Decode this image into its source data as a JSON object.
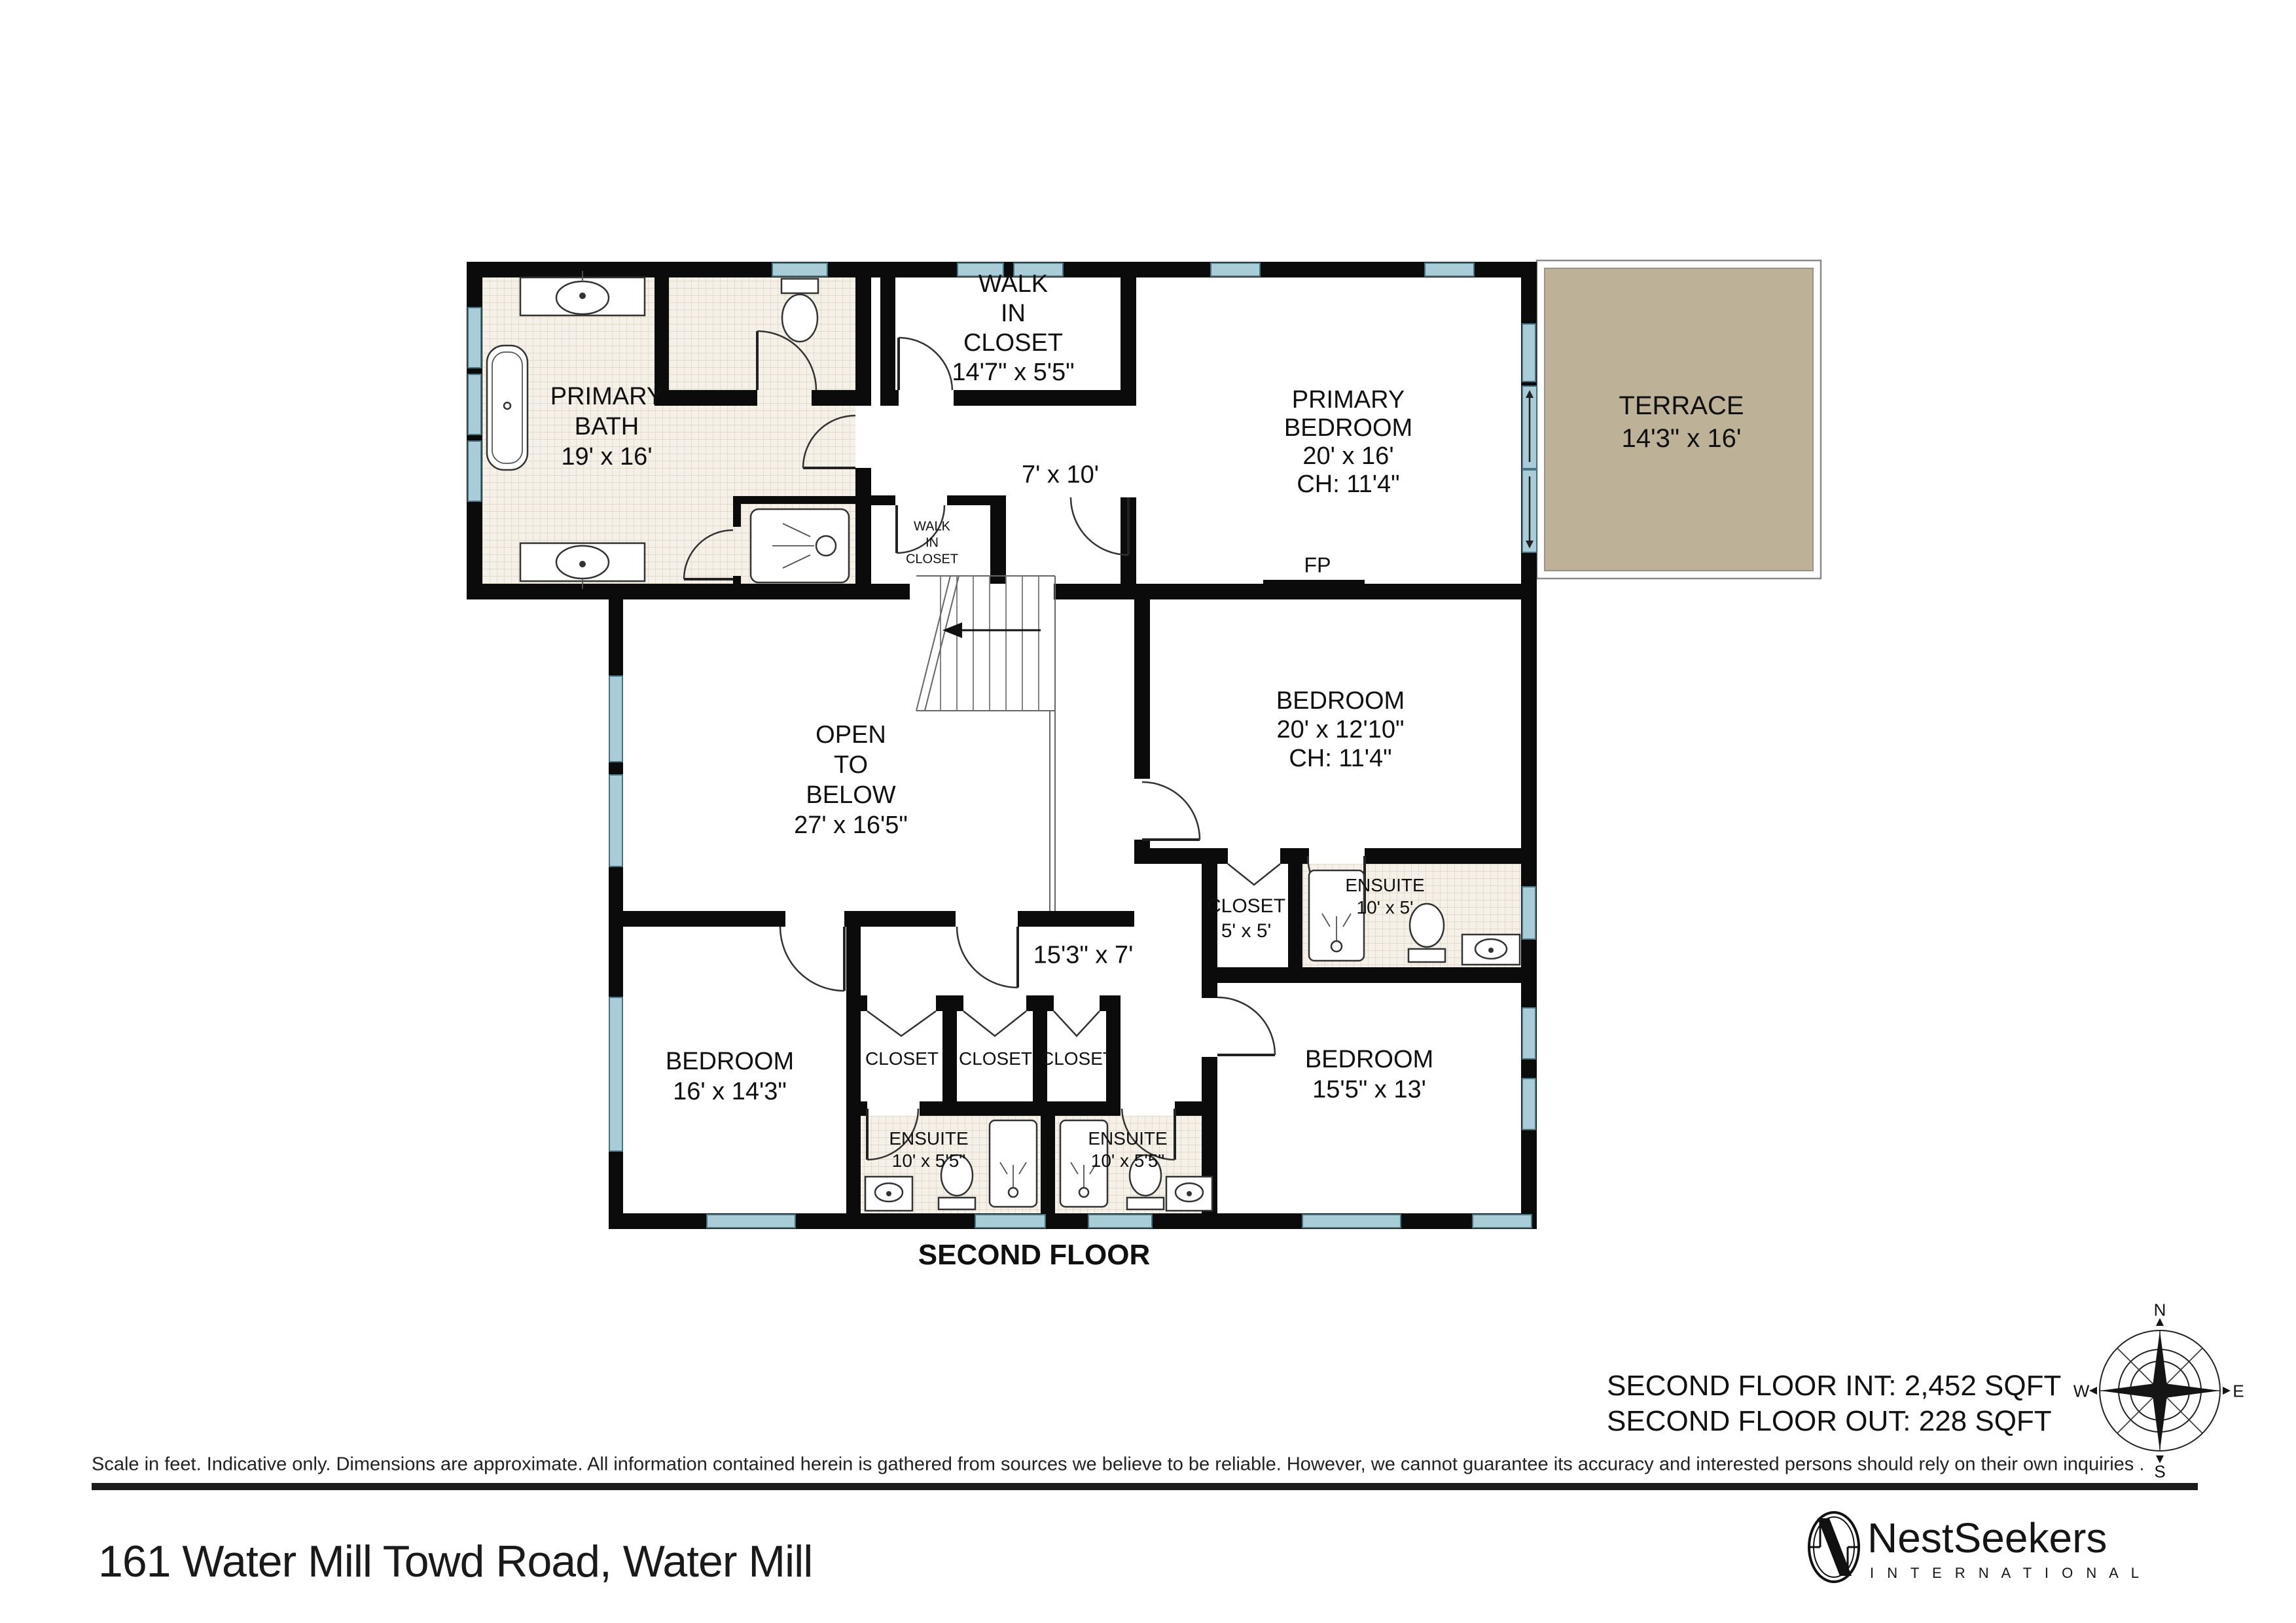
{
  "floor_title": "SECOND FLOOR",
  "address": "161 Water Mill Towd Road, Water Mill",
  "stats": {
    "interior": "SECOND FLOOR INT: 2,452 SQFT",
    "exterior": "SECOND FLOOR OUT: 228 SQFT"
  },
  "disclaimer": "Scale in feet. Indicative only. Dimensions are approximate. All information contained herein is gathered from sources we believe to be reliable. However, we cannot guarantee its accuracy and interested persons should rely on their own inquiries .",
  "brand": {
    "name": "NestSeekers",
    "tagline": "I N T E R N A T I O N A L"
  },
  "compass": {
    "north": "N",
    "east": "E",
    "south": "S",
    "west": "W"
  },
  "rooms": {
    "primary_bath": {
      "lines": [
        "PRIMARY",
        "BATH",
        "19' x 16'"
      ]
    },
    "walk_in_closet": {
      "lines": [
        "WALK",
        "IN",
        "CLOSET",
        "14'7\" x 5'5\""
      ]
    },
    "upper_hall": {
      "lines": [
        "7' x 10'"
      ]
    },
    "small_wic": {
      "lines": [
        "WALK",
        "IN",
        "CLOSET"
      ]
    },
    "primary_bedroom": {
      "lines": [
        "PRIMARY",
        "BEDROOM",
        "20' x 16'",
        "CH: 11'4\""
      ]
    },
    "fireplace": {
      "lines": [
        "FP"
      ]
    },
    "terrace": {
      "lines": [
        "TERRACE",
        "14'3\" x 16'"
      ]
    },
    "open_below": {
      "lines": [
        "OPEN",
        "TO",
        "BELOW",
        "27' x 16'5\""
      ]
    },
    "bedroom_2": {
      "lines": [
        "BEDROOM",
        "20' x 12'10\"",
        "CH: 11'4\""
      ]
    },
    "closet_5": {
      "lines": [
        "CLOSET",
        "5' x 5'"
      ]
    },
    "ensuite_mid": {
      "lines": [
        "ENSUITE",
        "10' x 5'"
      ]
    },
    "lower_hall": {
      "lines": [
        "15'3\" x 7'"
      ]
    },
    "bedroom_3": {
      "lines": [
        "BEDROOM",
        "16' x 14'3\""
      ]
    },
    "closet_a": {
      "lines": [
        "CLOSET"
      ]
    },
    "closet_b": {
      "lines": [
        "CLOSET"
      ]
    },
    "closet_c": {
      "lines": [
        "CLOSET"
      ]
    },
    "ensuite_bl": {
      "lines": [
        "ENSUITE",
        "10' x 5'5\""
      ]
    },
    "ensuite_bm": {
      "lines": [
        "ENSUITE",
        "10' x 5'5\""
      ]
    },
    "bedroom_4": {
      "lines": [
        "BEDROOM",
        "15'5\" x 13'"
      ]
    }
  },
  "colors": {
    "wall": "#0b0b0b",
    "window": "#a8cdd8",
    "window_border": "#46737f",
    "terrace": "#bdb197",
    "tile_bg": "#f5f1e9",
    "tile_line": "#dcd3c0",
    "rule": "#1c1c1c"
  }
}
